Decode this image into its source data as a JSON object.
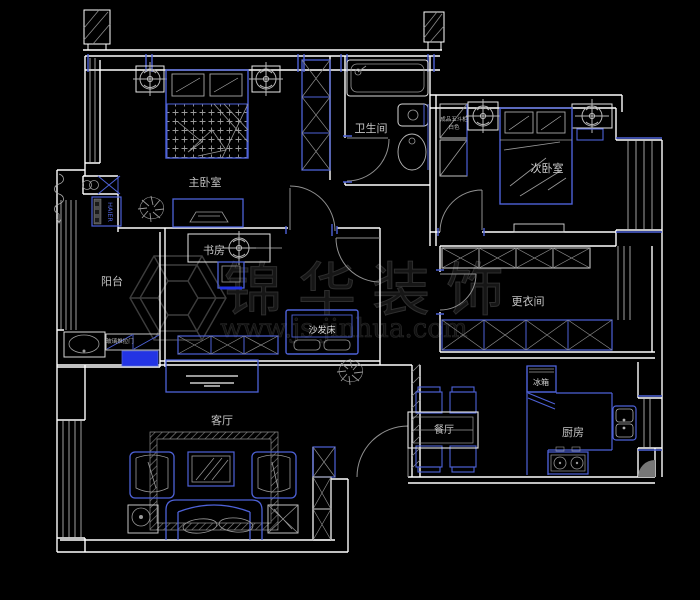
{
  "watermark": {
    "brand": "锦华装饰",
    "url": "www.js-jinhua.com"
  },
  "rooms": [
    {
      "id": "master-bedroom",
      "label": "主卧室"
    },
    {
      "id": "bathroom",
      "label": "卫生间"
    },
    {
      "id": "second-bedroom",
      "label": "次卧室"
    },
    {
      "id": "balcony",
      "label": "阳台"
    },
    {
      "id": "study",
      "label": "书房"
    },
    {
      "id": "dressing-room",
      "label": "更衣间"
    },
    {
      "id": "living-room",
      "label": "客厅"
    },
    {
      "id": "dining-room",
      "label": "餐厅"
    },
    {
      "id": "kitchen",
      "label": "厨房"
    }
  ],
  "furniture": {
    "sofa_bed": "沙发床",
    "fridge": "冰箱"
  },
  "notes": {
    "cabinet_line1": "成品五斗柜",
    "cabinet_line2": "白色",
    "sliding_door": "玻璃推拉门",
    "appliance_brand": "HAIER"
  },
  "colors": {
    "background": "#000000",
    "walls": "#ffffff",
    "furniture_blue": "#4e62d8",
    "solid_blue": "#2334e4",
    "detail_gray": "#999999",
    "watermark": "#1a1a1a"
  }
}
